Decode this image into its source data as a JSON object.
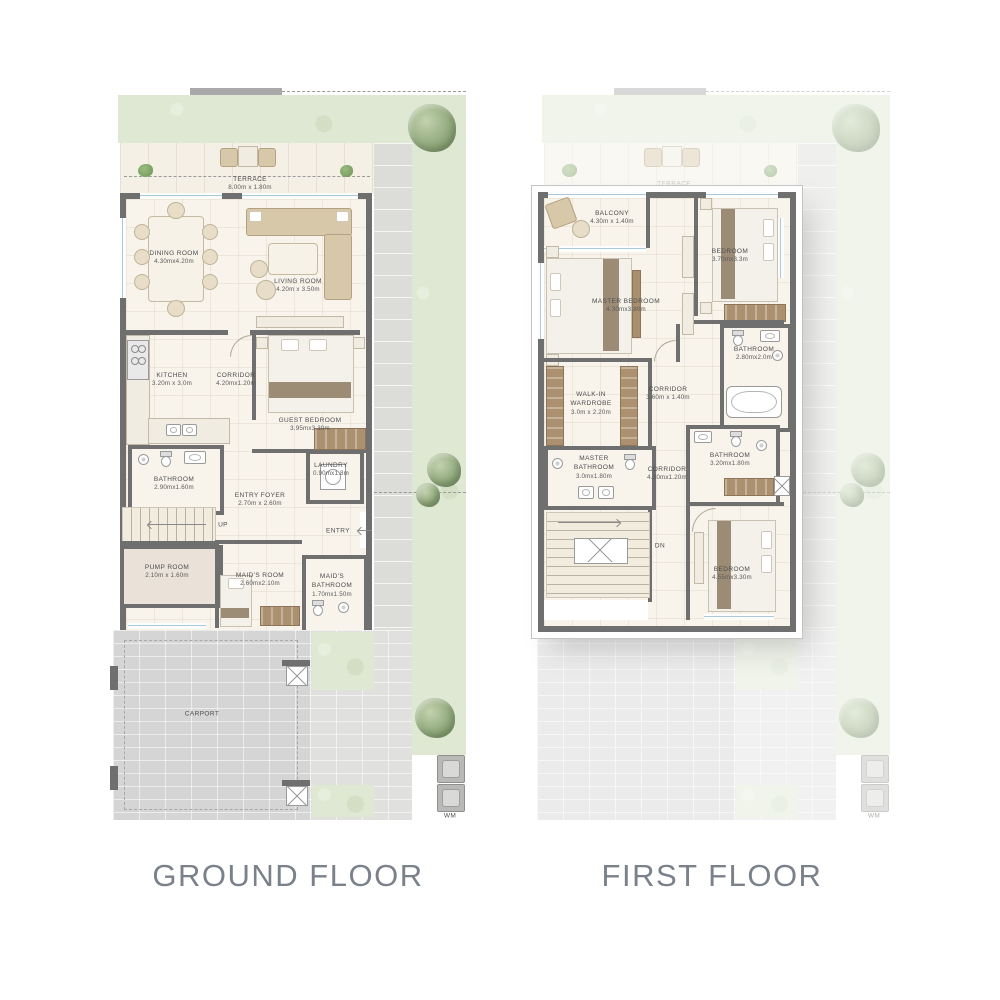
{
  "palette": {
    "background": "#ffffff",
    "garden": "#dfe8d2",
    "paving": "#d9dad8",
    "floor": "#f8f4ec",
    "wall": "#6f6f6f",
    "wood": "#a8906d",
    "window": "#a9c9dd",
    "title_text": "#7b818a",
    "label_text": "#4c4c4c"
  },
  "titles": {
    "ground": "GROUND FLOOR",
    "first": "FIRST FLOOR"
  },
  "ground_floor": {
    "rooms": [
      {
        "name": "TERRACE",
        "dims": "8.00m x 1.80m"
      },
      {
        "name": "DINING ROOM",
        "dims": "4.30mx4.20m"
      },
      {
        "name": "LIVING ROOM",
        "dims": "4.20m x 3.50m"
      },
      {
        "name": "KITCHEN",
        "dims": "3.20m x 3.0m"
      },
      {
        "name": "CORRIDOR",
        "dims": "4.20mx1.20m"
      },
      {
        "name": "GUEST BEDROOM",
        "dims": "3.95mx3.30m"
      },
      {
        "name": "BATHROOM",
        "dims": "2.90mx1.60m"
      },
      {
        "name": "LAUNDRY",
        "dims": "0.90mx1.8m"
      },
      {
        "name": "ENTRY FOYER",
        "dims": "2.70m x 2.60m"
      },
      {
        "name": "PUMP ROOM",
        "dims": "2.10m x 1.60m"
      },
      {
        "name": "MAID'S ROOM",
        "dims": "2.60mx2.10m"
      },
      {
        "name": "MAID'S BATHROOM",
        "dims": "1.70mx1.50m"
      },
      {
        "name": "CARPORT",
        "dims": ""
      }
    ],
    "markers": {
      "up": "UP",
      "entry": "ENTRY",
      "water_meter": "WM"
    }
  },
  "first_floor": {
    "rooms": [
      {
        "name": "TERRACE",
        "dims": ""
      },
      {
        "name": "BALCONY",
        "dims": "4.30m x 1.40m"
      },
      {
        "name": "BEDROOM",
        "dims": "3.70mx3.3m"
      },
      {
        "name": "MASTER BEDROOM",
        "dims": "4.30mx3.80m"
      },
      {
        "name": "BATHROOM",
        "dims": "2.80mx2.0m"
      },
      {
        "name": "WALK-IN WARDROBE",
        "dims": "3.0m x 2.20m"
      },
      {
        "name": "CORRIDOR",
        "dims": "3.60m x 1.40m"
      },
      {
        "name": "MASTER BATHROOM",
        "dims": "3.0mx1.80m"
      },
      {
        "name": "CORRIDOR",
        "dims": "4.30mx1.20m"
      },
      {
        "name": "BATHROOM",
        "dims": "3.20mx1.80m"
      },
      {
        "name": "BEDROOM",
        "dims": "4.55mx3.30m"
      }
    ],
    "markers": {
      "down": "DN",
      "water_meter": "WM"
    }
  }
}
